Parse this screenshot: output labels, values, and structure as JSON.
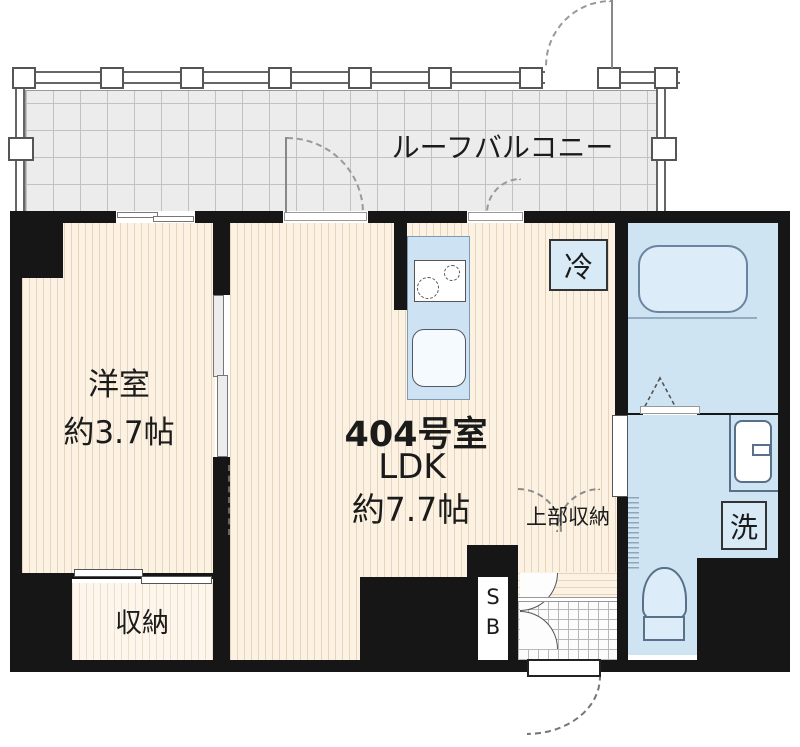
{
  "plan": {
    "balcony": {
      "label": "ルーフバルコニー"
    },
    "western_room": {
      "name": "洋室",
      "size": "約3.7帖"
    },
    "ldk": {
      "unit": "404号室",
      "name": "LDK",
      "size": "約7.7帖"
    },
    "closet": {
      "label": "収納"
    },
    "upper_storage": {
      "label": "上部収納"
    },
    "fridge": {
      "label": "冷"
    },
    "washer": {
      "label": "洗"
    },
    "shaft_box": {
      "top": "S",
      "bottom": "B"
    }
  },
  "colors": {
    "wall": "#161616",
    "wood_floor": "#fbf2e3",
    "water_area": "#cfe4f3",
    "balcony": "#ececec"
  }
}
